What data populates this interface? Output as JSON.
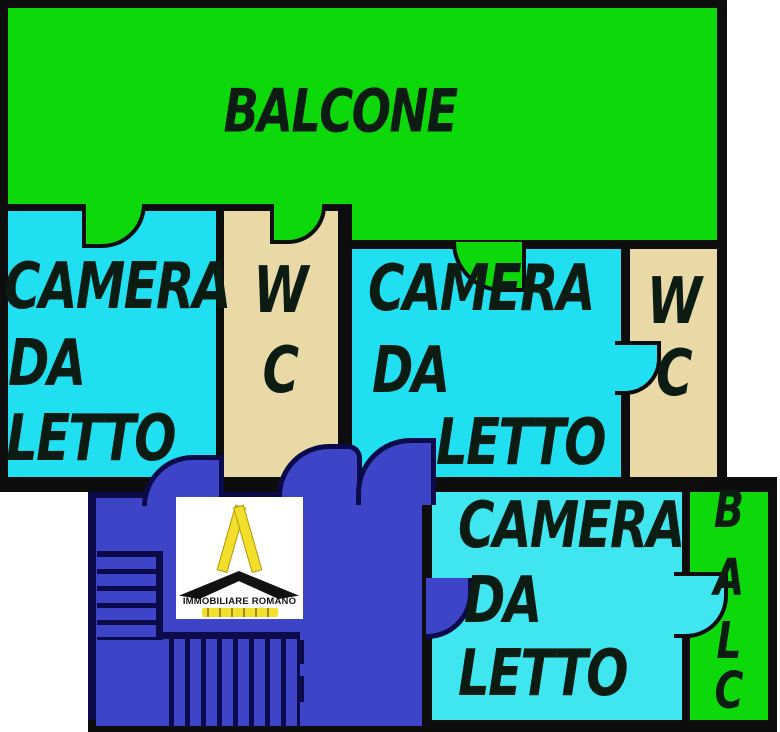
{
  "floorplan": {
    "balcone": {
      "label": "BALCONE"
    },
    "camera1": {
      "lines": [
        "CAMERA",
        "DA",
        "LETTO"
      ]
    },
    "wc1": {
      "lines": [
        "W",
        "C"
      ]
    },
    "camera2": {
      "lines": [
        "CAMERA",
        "DA",
        "LETTO"
      ]
    },
    "wc2": {
      "lines": [
        "W",
        "C"
      ]
    },
    "camera3": {
      "lines": [
        "CAMERA",
        "DA",
        "LETTO"
      ]
    },
    "balc": {
      "letters": [
        "B",
        "A",
        "L",
        "C"
      ]
    },
    "logo": {
      "title": "IMMOBILIARE ROMANO"
    }
  },
  "colors": {
    "green": "#0cd80a",
    "cyan": "#1fdff1",
    "cyan2": "#3fe6f0",
    "tan": "#e9d9a7",
    "blue": "#3d44c7",
    "navy": "#0b0b4a",
    "wall": "#0d0d0d",
    "ink": "#0c1c12",
    "yellow": "#f2df2b",
    "white": "#ffffff"
  }
}
